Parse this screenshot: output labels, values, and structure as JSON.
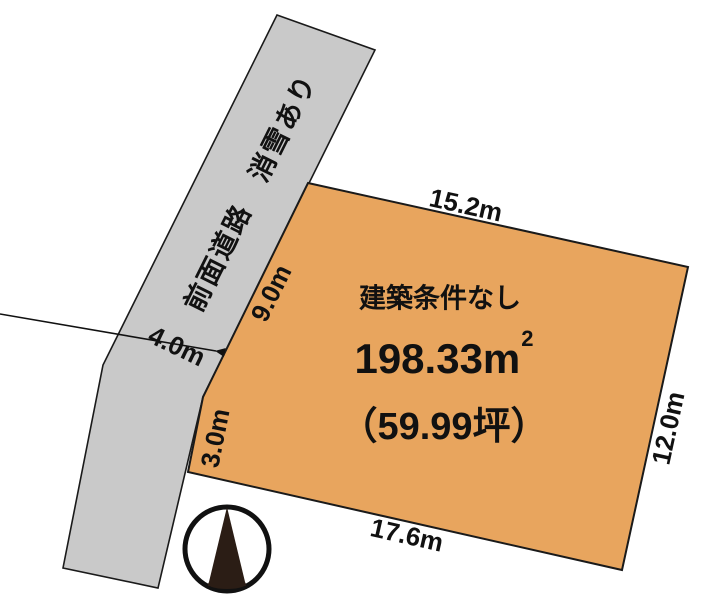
{
  "road": {
    "label": "前面道路　消雪あり",
    "width_label": "4.0m",
    "fill": "#C9C9C9"
  },
  "parcel": {
    "fill": "#E8A55E",
    "condition": "建築条件なし",
    "area_m2_value": "198.33m",
    "area_m2_sup": "2",
    "area_tsubo": "（59.99坪）",
    "dim_top": "15.2m",
    "dim_right": "12.0m",
    "dim_bottom": "17.6m",
    "dim_left_upper": "9.0m",
    "dim_left_lower": "3.0m"
  },
  "compass": {
    "icon": "north-arrow",
    "fill": "#2B1D15"
  },
  "colors": {
    "outline": "#1A1A1A",
    "text": "#111111"
  }
}
